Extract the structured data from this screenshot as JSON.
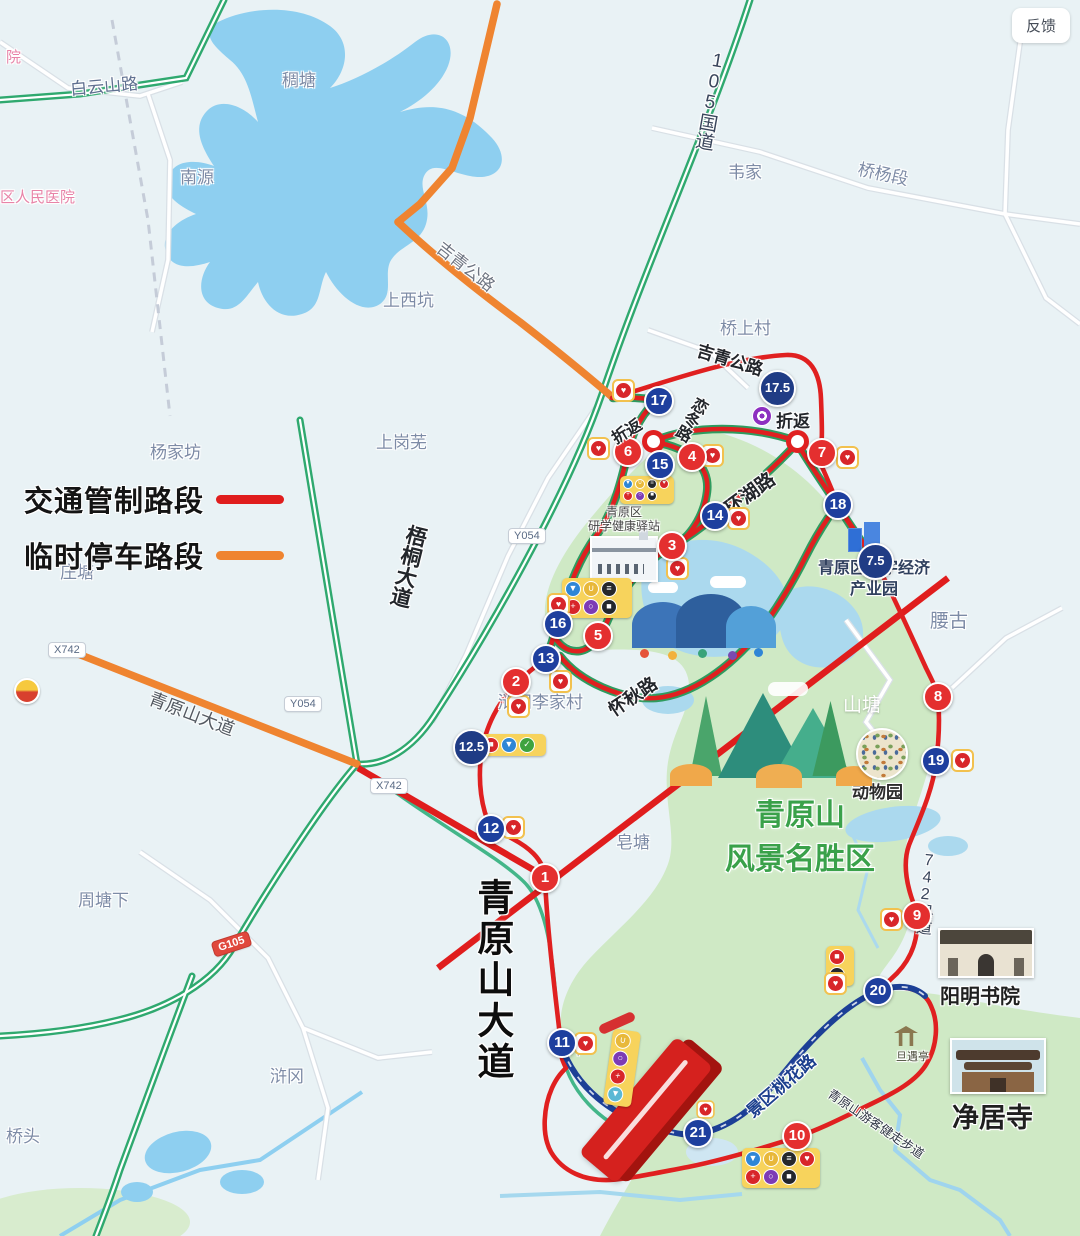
{
  "ui": {
    "feedback": "反馈"
  },
  "legend": {
    "traffic_control": "交通管制路段",
    "temp_parking": "临时停车路段"
  },
  "colors": {
    "traffic_control_red": "#e01d1d",
    "temp_parking_orange": "#ef8430",
    "course_red": "#e02020",
    "walkway_blue": "#1c3f96",
    "marker_red": "#e42f2f",
    "marker_blue": "#1e3f9e",
    "scenic_green": "#cfe9c5",
    "water_blue": "#8ecff0",
    "highway_green": "#2fa96f"
  },
  "route_markers": [
    "1",
    "2",
    "3",
    "4",
    "5",
    "6",
    "7",
    "8",
    "9",
    "10",
    "11",
    "12",
    "13",
    "14",
    "15",
    "16",
    "17",
    "18",
    "19",
    "20",
    "21"
  ],
  "km_badges": [
    "17.5",
    "7.5",
    "12.5"
  ],
  "road_badges": {
    "y054": "Y054",
    "x742": "X742",
    "g105": "G105"
  },
  "roads": {
    "g105_national": "105国道",
    "baiyunshan": "白云山路",
    "jiqing": "吉青公路",
    "wutong": "梧桐大道",
    "qingyuanshan_avenue": "青原山大道",
    "liandong": "恋冬路",
    "huanhu": "环湖路",
    "huaiqiu": "怀秋路",
    "x742_county": "742县道",
    "taohua": "景区桃花路",
    "jianzou": "青原山游客健走步道"
  },
  "places": {
    "hospital_partial": "院",
    "hospital": "区人民医院",
    "choutang": "稠塘",
    "nanyuan": "南源",
    "weijia": "韦家",
    "qiaoyang": "桥杨段",
    "shangxikeng": "上西坑",
    "qiaoshangcun": "桥上村",
    "yangjiafang": "杨家坊",
    "shanggangwu": "上岗芜",
    "zhuangtang": "庄塘",
    "yaogu": "腰古",
    "shantang": "山塘",
    "zaotang": "皂塘",
    "zhoutangxia": "周塘下",
    "qiaotou": "桥头",
    "hugang": "浒冈",
    "shanxia": "山下",
    "lijiacun": "浒冈李家村"
  },
  "pois": {
    "yanxue_line1": "青原区",
    "yanxue_line2": "研学健康驿站",
    "digital_line1": "青原区数字经济",
    "digital_line2": "产业园",
    "scenic_line1": "青原山",
    "scenic_line2": "风景名胜区",
    "zoo": "动物园",
    "yangming": "阳明书院",
    "jingju": "净居寺",
    "danyu": "旦遇亭"
  },
  "labels": {
    "turnaround": "折返"
  },
  "icons": {
    "water": "▼",
    "drink": "∪",
    "food": "≡",
    "heart": "♥",
    "aid": "+",
    "sponge": "○",
    "camera": "■",
    "bus": "■",
    "check": "✓"
  }
}
